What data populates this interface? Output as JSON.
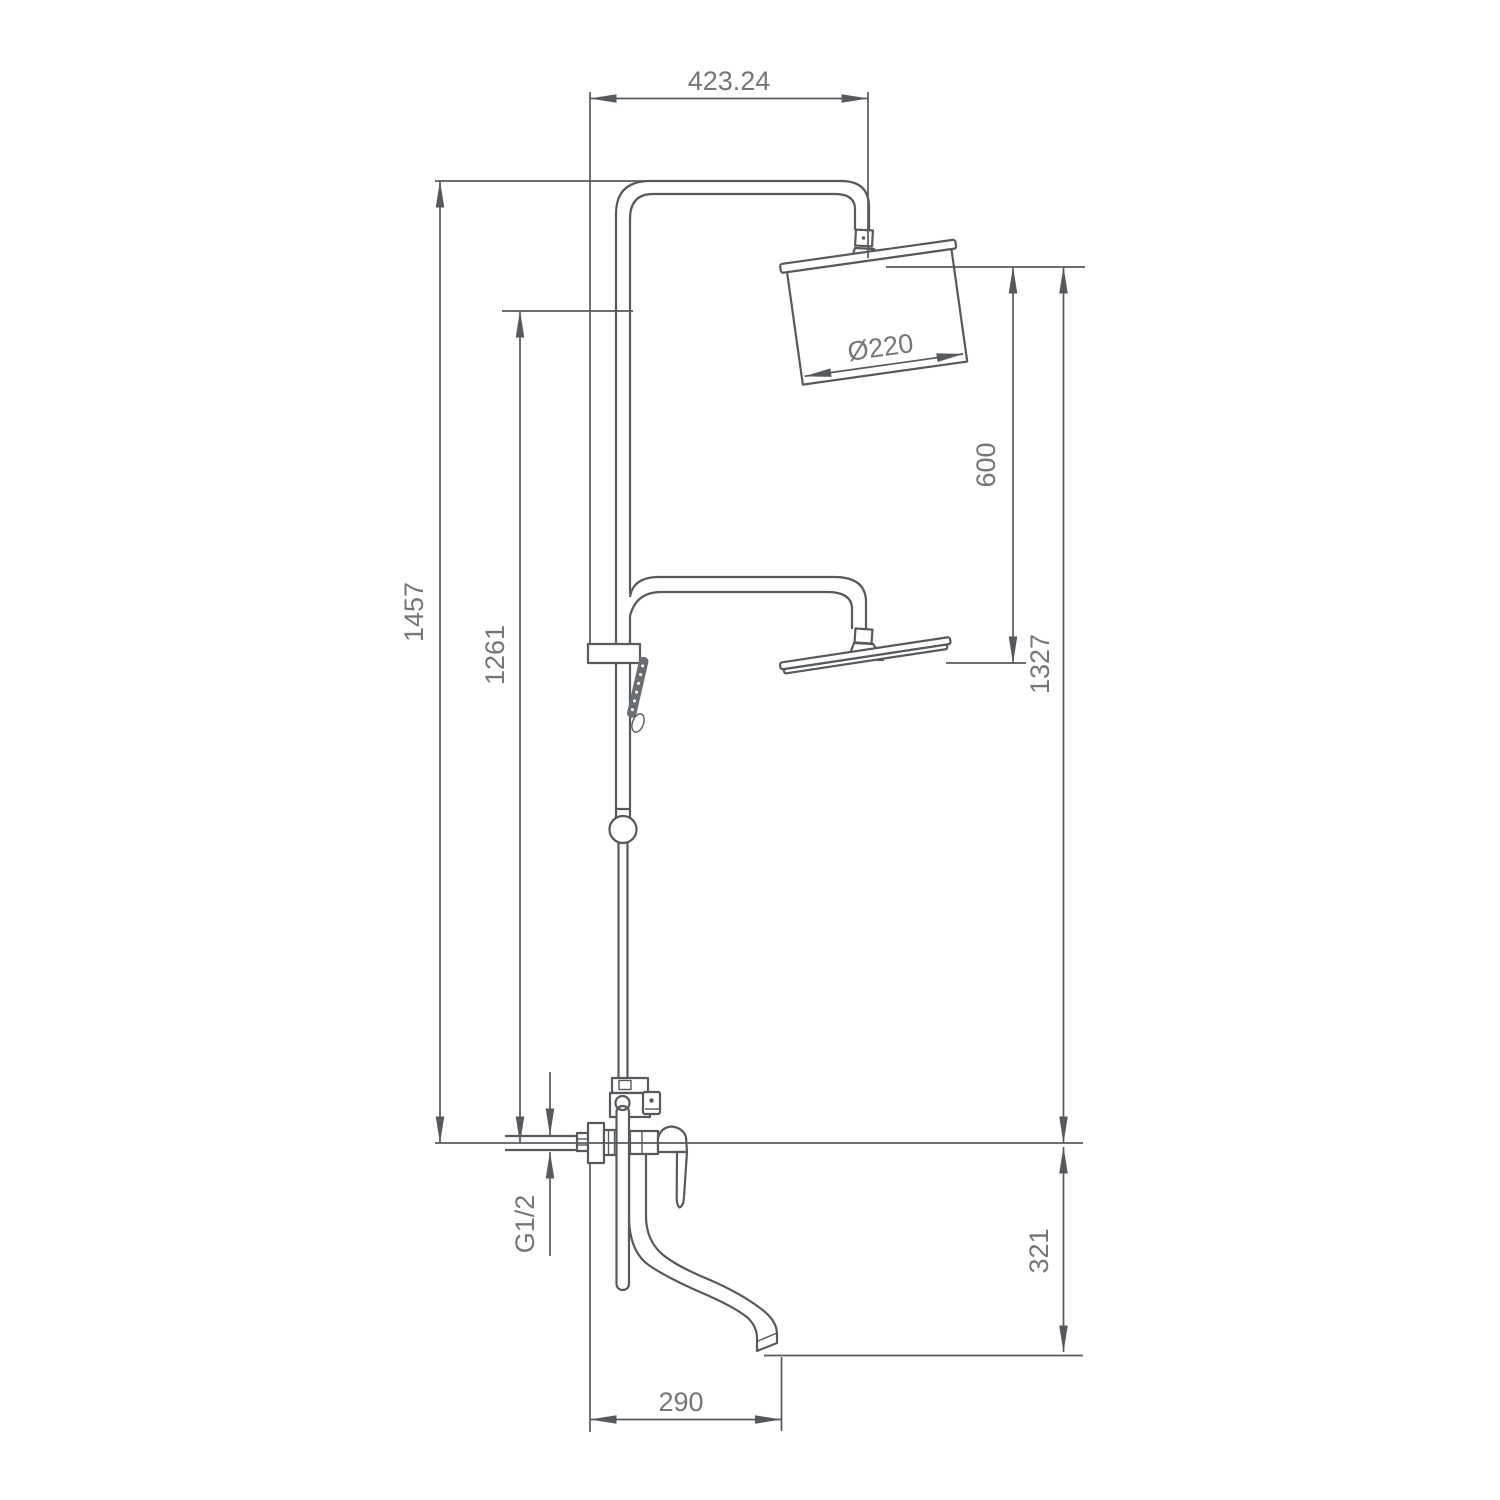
{
  "drawing": {
    "background": "#ffffff",
    "line_color": "#565a5e",
    "text_color": "#74777a",
    "labels": {
      "top_width": "423.24",
      "total_height": "1457",
      "riser_height": "1261",
      "head_spacing": "600",
      "head_height": "1327",
      "spout_drop": "321",
      "spout_reach": "290",
      "inlet_thread": "G1/2",
      "head_diameter": "Ø220"
    }
  }
}
